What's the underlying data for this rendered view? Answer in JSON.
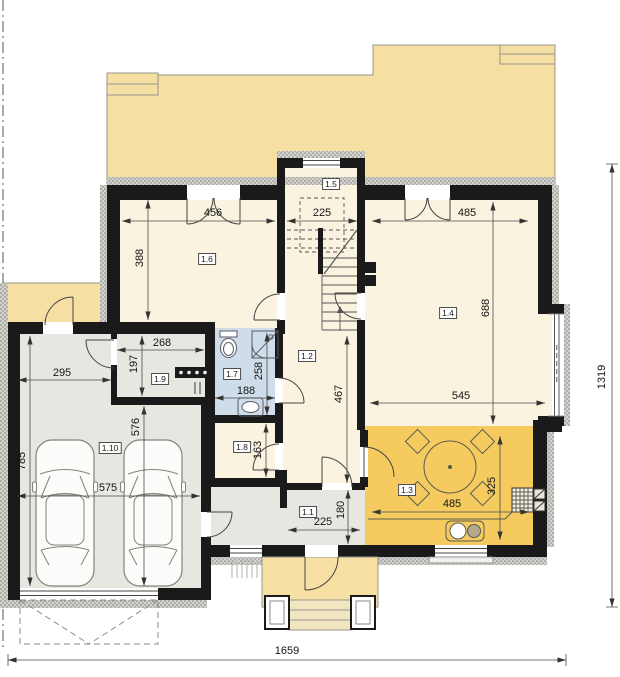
{
  "plan": {
    "type": "house-ground-floor-plan",
    "colors": {
      "terrace": "#f6dfa3",
      "room_cream": "#faf3e0",
      "kitchen_orange": "#f5cb60",
      "bathroom_blue": "#cfdcea",
      "garage_gray": "#e8e6e1",
      "wall_black": "#1a1a1a",
      "hatch_gray": "#9a9894",
      "dimension_line": "#4a4a4a"
    }
  },
  "labels": {
    "l1_1": "1.1",
    "l1_2": "1.2",
    "l1_3": "1.3",
    "l1_4": "1.4",
    "l1_5": "1.5",
    "l1_6": "1.6",
    "l1_7": "1.7",
    "l1_8": "1.8",
    "l1_9": "1.9",
    "l1_10": "1.10"
  },
  "rooms": [
    {
      "id": "1.1",
      "floor": "gray"
    },
    {
      "id": "1.2",
      "floor": "cream"
    },
    {
      "id": "1.3",
      "floor": "orange"
    },
    {
      "id": "1.4",
      "floor": "cream"
    },
    {
      "id": "1.5",
      "floor": "cream"
    },
    {
      "id": "1.6",
      "floor": "cream"
    },
    {
      "id": "1.7",
      "floor": "blue"
    },
    {
      "id": "1.8",
      "floor": "cream"
    },
    {
      "id": "1.9",
      "floor": "gray"
    },
    {
      "id": "1.10",
      "floor": "gray"
    }
  ],
  "dims": {
    "room16_w": "456",
    "room16_h": "388",
    "stair_w": "225",
    "living_w": "485",
    "living_h": "688",
    "living_w2": "545",
    "ward_w": "268",
    "ward_h": "197",
    "garage_w2": "295",
    "bath_w": "188",
    "bath_h": "258",
    "hall_h": "467",
    "pantry_h": "163",
    "garage_h2": "576",
    "garage_h": "785",
    "garage_w": "575",
    "entry_w": "225",
    "entry_h": "180",
    "kitchen_w": "485",
    "kitchen_h": "325",
    "total_w": "1659",
    "total_h": "1319"
  }
}
